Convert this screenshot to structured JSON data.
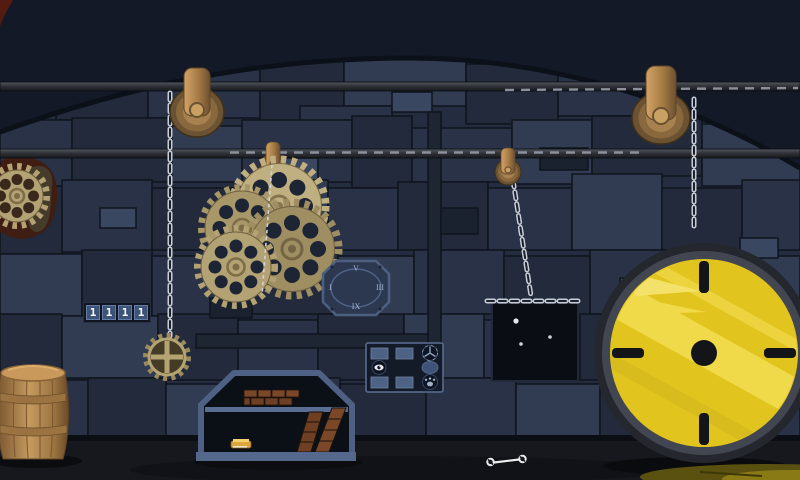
{
  "lock": {
    "digits": [
      "1",
      "1",
      "1",
      "1"
    ],
    "cell_color": "#3e5378",
    "digit_color": "#ffffff"
  },
  "clock_plate": {
    "numerals": {
      "top": "V",
      "right": "III",
      "bottom": "IX",
      "left": "I"
    },
    "plate_color": "#2c3850",
    "numeral_color": "#9fb2cf"
  },
  "button_panel": {
    "rows": 3,
    "cols": 3,
    "cells": [
      [
        "blank-key",
        "blank-key",
        "wheel-icon"
      ],
      [
        "eye-icon",
        "empty",
        "oval-key"
      ],
      [
        "blank-key",
        "blank-key",
        "paw-icon"
      ]
    ]
  },
  "star_panel": {
    "star_count": 3
  },
  "objects": {
    "pulleys": 4,
    "hanging_gears": 4,
    "pendant_gear": 1,
    "wall_gear": 1,
    "barrel_color": "#c49a5e",
    "vault_wheel_color": "#e2c41f",
    "chain_color": "#c9ced6",
    "brass_color": "#a8824e",
    "brick_color": "#7a4729",
    "fireplace_frame_color": "#4e6184",
    "wall_color": "#242d3f",
    "ceiling_color": "#141927",
    "floor_color": "#16181d",
    "puddle_color": "#8a7a16"
  }
}
